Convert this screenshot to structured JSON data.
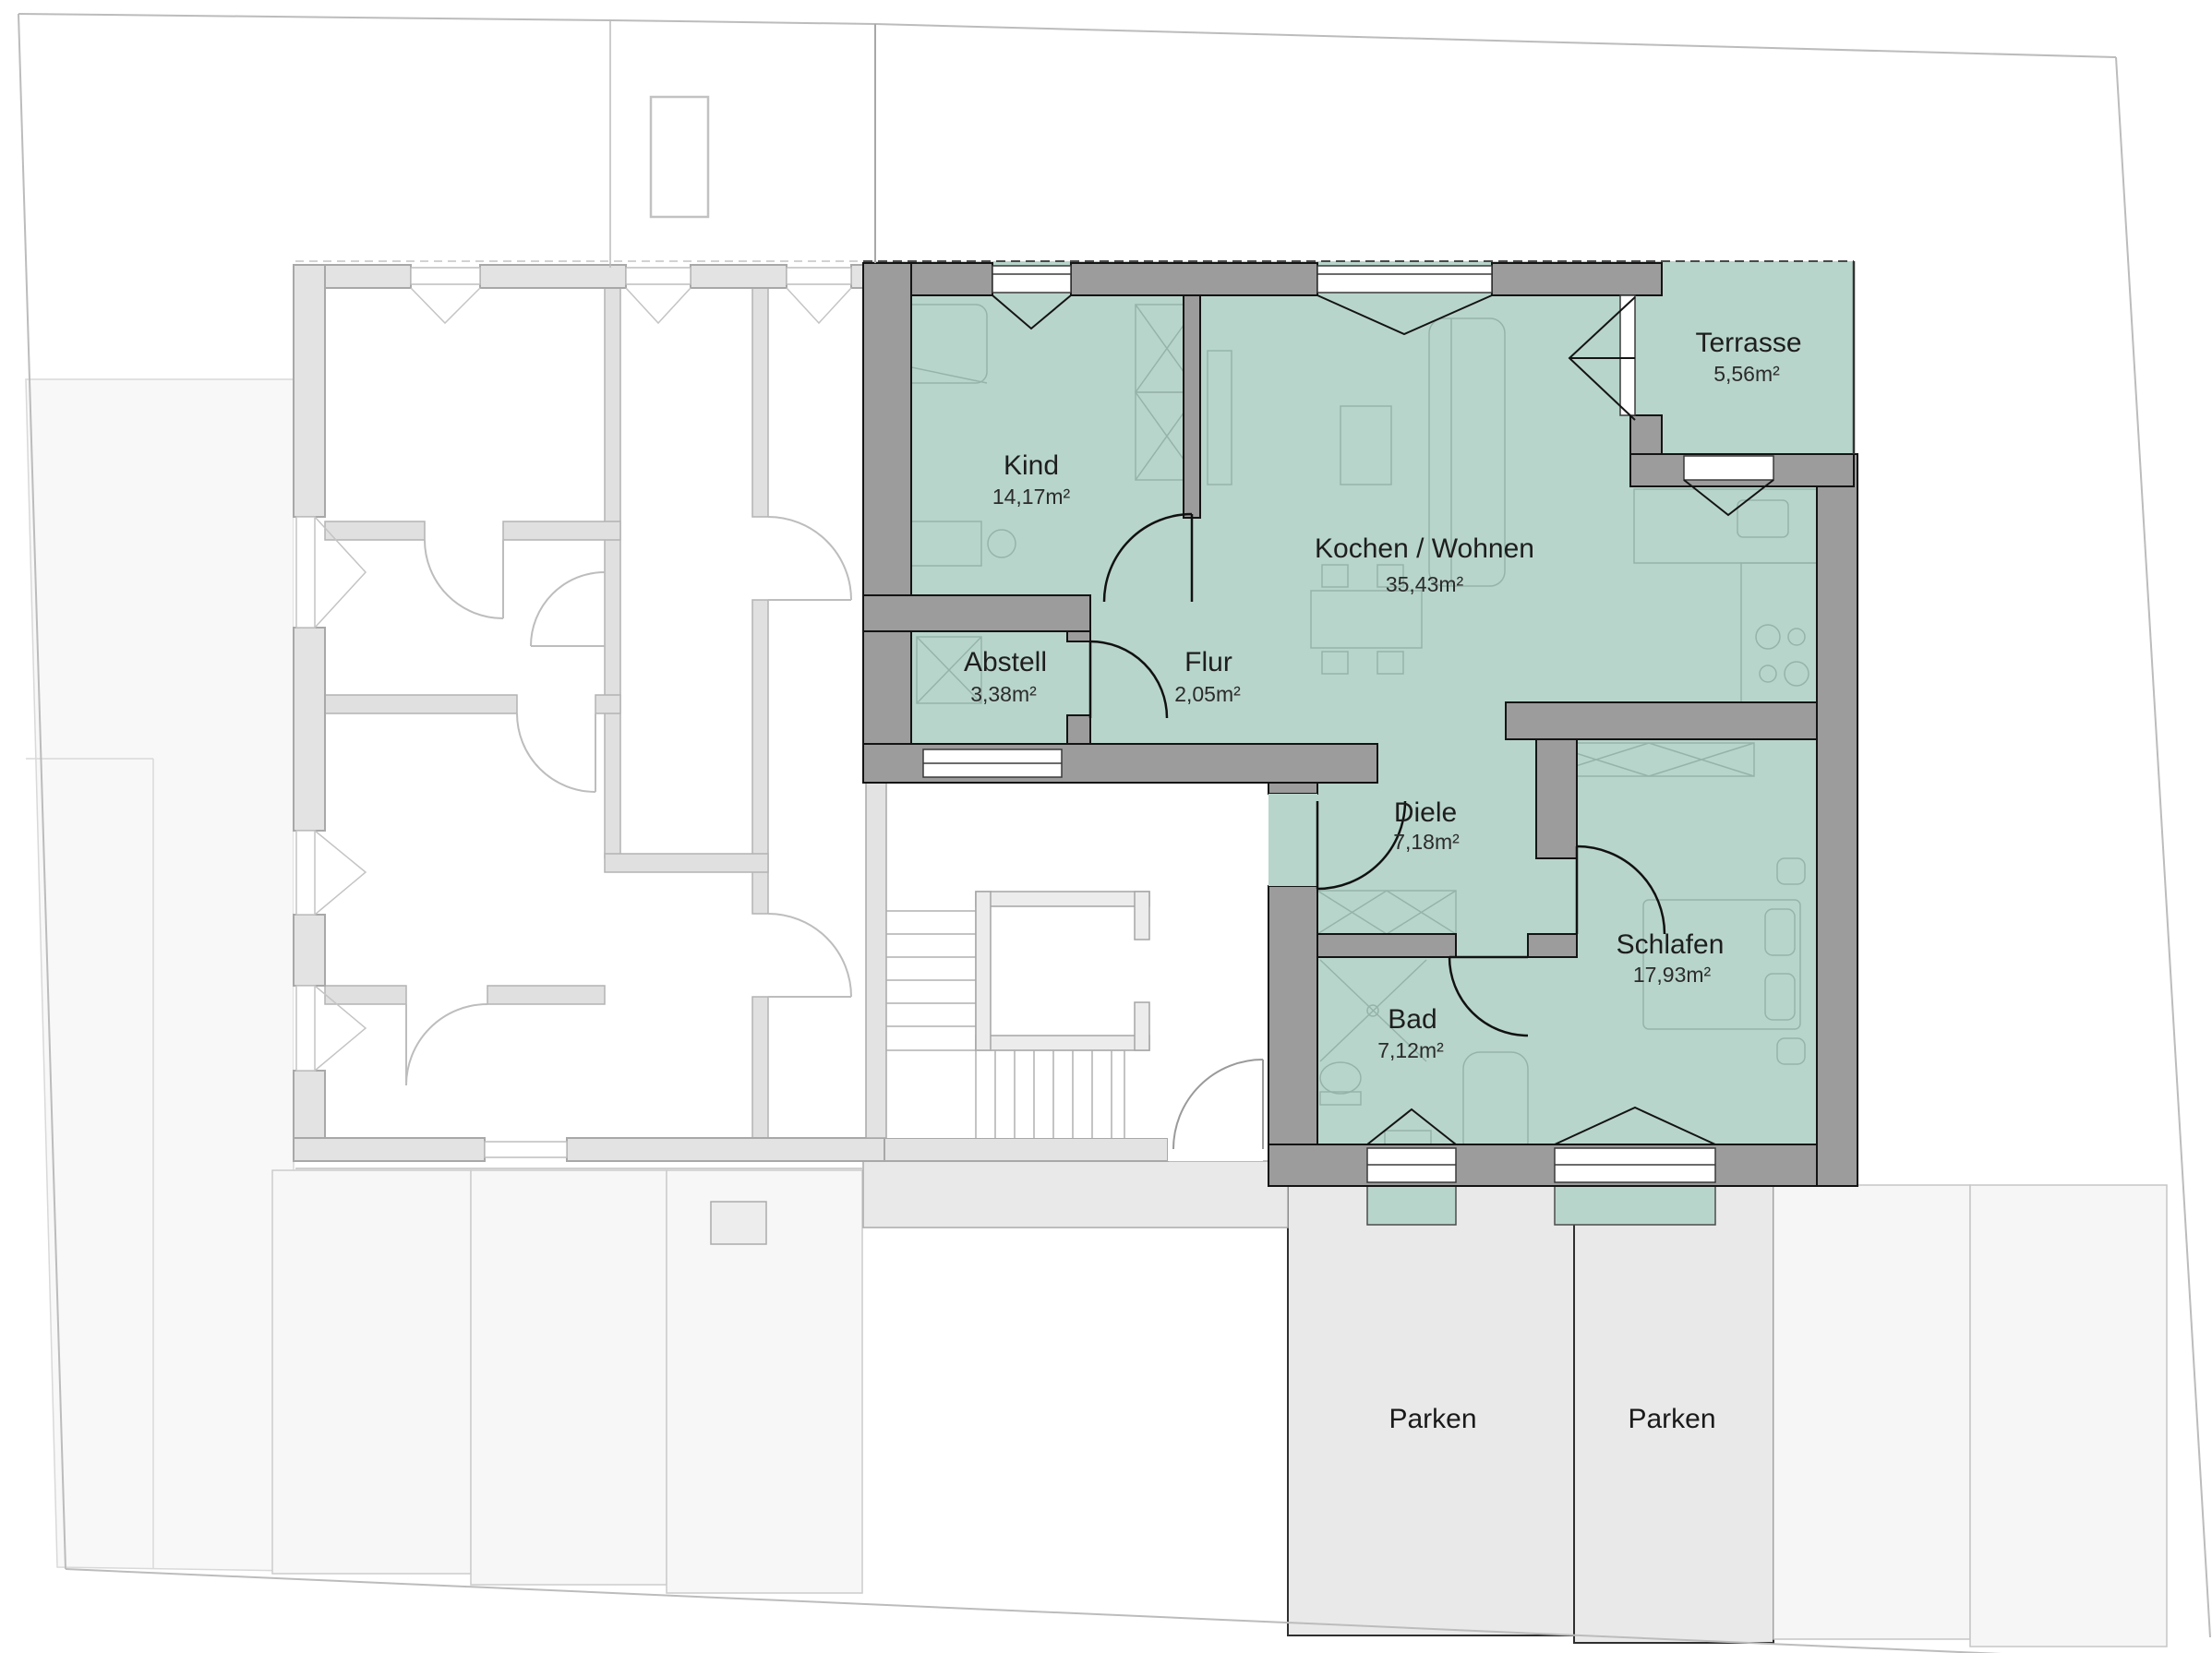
{
  "floorplan": {
    "rooms": [
      {
        "id": "kind",
        "name": "Kind",
        "area": "14,17m²"
      },
      {
        "id": "kochen-wohnen",
        "name": "Kochen / Wohnen",
        "area": "35,43m²"
      },
      {
        "id": "abstell",
        "name": "Abstell",
        "area": "3,38m²"
      },
      {
        "id": "flur",
        "name": "Flur",
        "area": "2,05m²"
      },
      {
        "id": "diele",
        "name": "Diele",
        "area": "7,18m²"
      },
      {
        "id": "bad",
        "name": "Bad",
        "area": "7,12m²"
      },
      {
        "id": "schlafen",
        "name": "Schlafen",
        "area": "17,93m²"
      },
      {
        "id": "terrasse",
        "name": "Terrasse",
        "area": "5,56m²"
      }
    ],
    "parking_spaces": [
      {
        "label": "Parken"
      },
      {
        "label": "Parken"
      }
    ],
    "colors": {
      "highlight_fill": "#b8d5cb",
      "dark_wall": "#9c9c9c",
      "light_wall": "#e3e3e3",
      "parking_fill": "#e9e9e9",
      "parking_light_fill": "#f6f6f6",
      "boundary_line": "#bcbcbc",
      "label_text": "#1e1e1e"
    }
  }
}
